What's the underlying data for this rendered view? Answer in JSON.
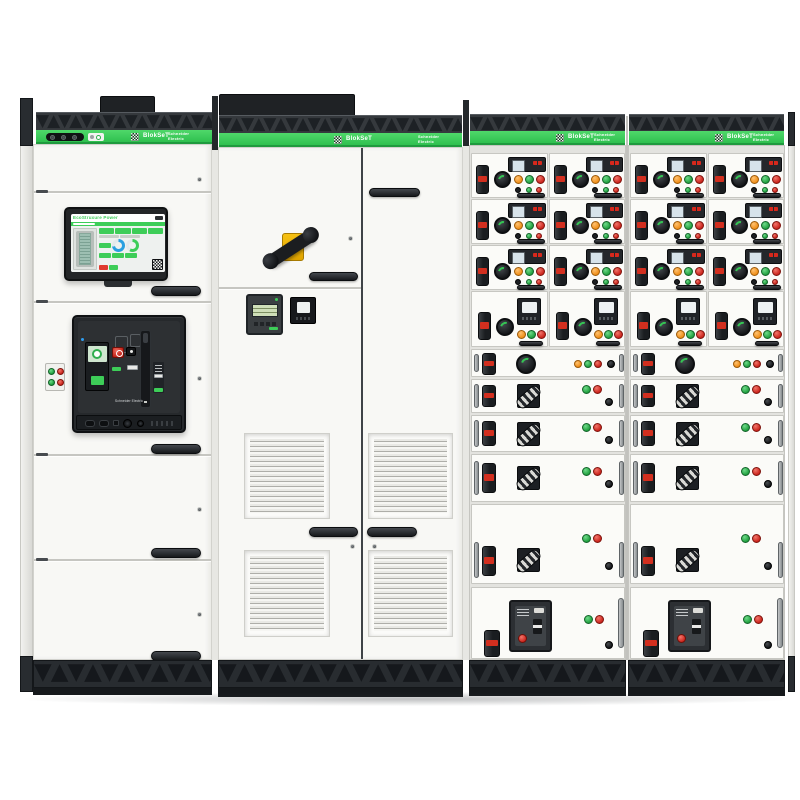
{
  "product": {
    "name": "BlokSeT",
    "brand_line1": "Schneider",
    "brand_line2": "Electric"
  },
  "hmi": {
    "header": "EcoStruxure Power"
  },
  "main_breaker": {
    "brand_label": "Schneider Electric"
  },
  "decor": {
    "vent_pattern": "▼▲▼▲▼▲▼▲▼▲▼▲▼▲▼▲▼▲▼▲▼▲▼▲▼▲▼▲▼▲▼▲▼▲▼▲▼▲▼▲"
  },
  "colors": {
    "schneider_green": "#3DCD58",
    "status_green": "#2F9E44",
    "status_red": "#D7281C",
    "status_orange": "#F59F00",
    "handle_yellow": "#EEB000",
    "panel_white": "#F8F8F5",
    "chassis_dark": "#34383C"
  }
}
